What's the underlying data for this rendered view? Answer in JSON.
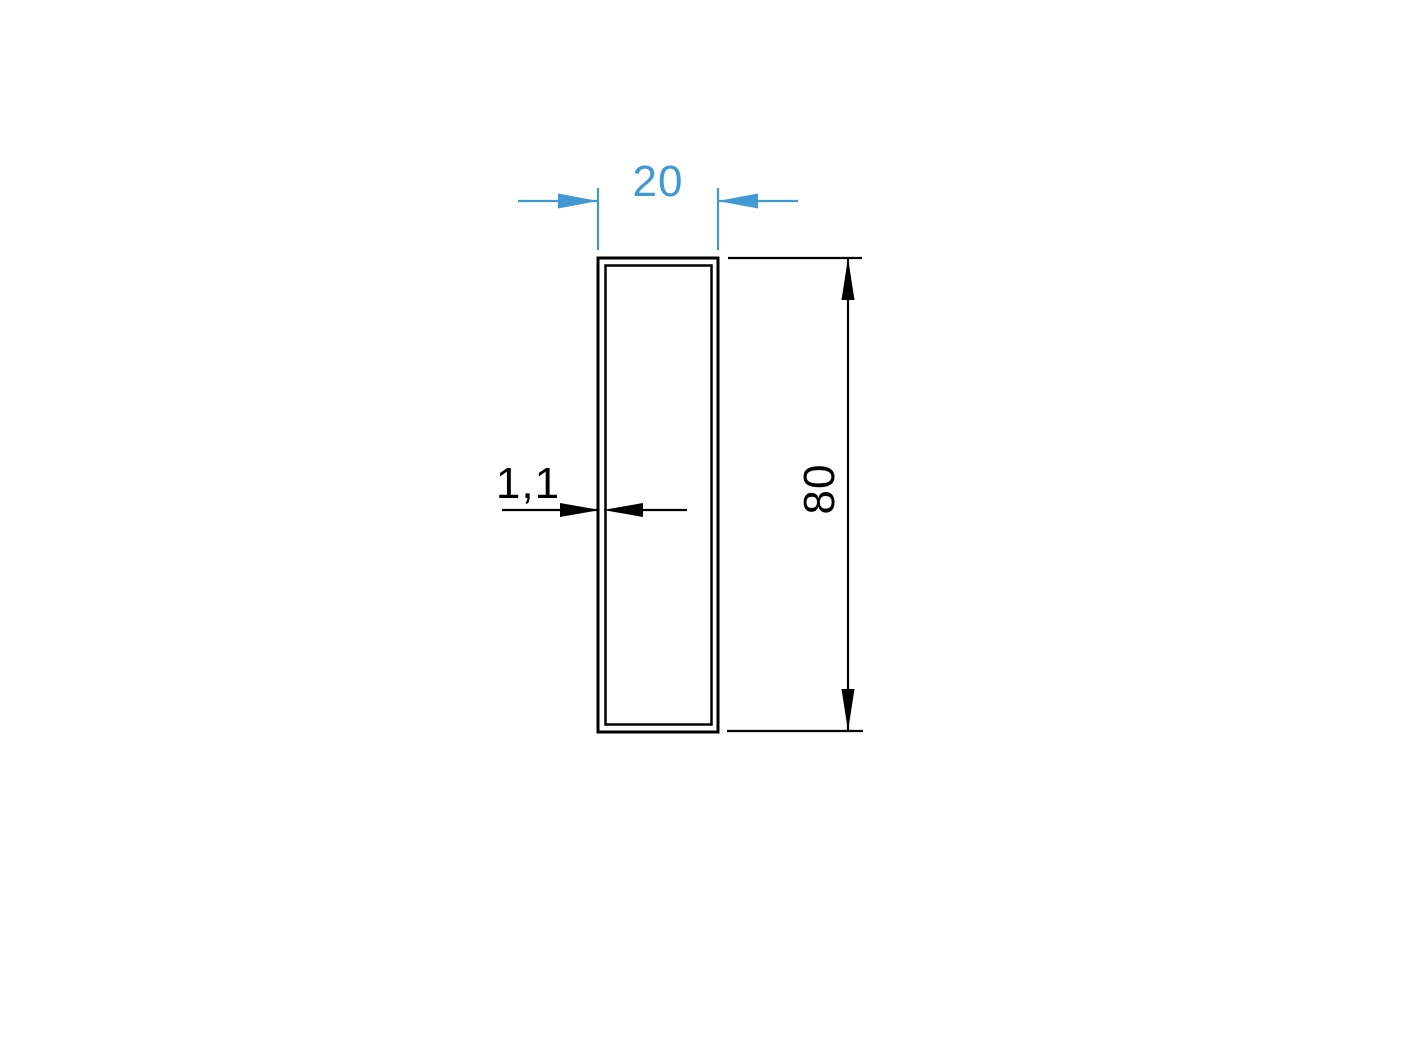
{
  "drawing": {
    "type": "technical-profile-cross-section",
    "dimensions": {
      "width": {
        "value": "20",
        "unit_hint": "",
        "orientation": "horizontal-top"
      },
      "height": {
        "value": "80",
        "unit_hint": "",
        "orientation": "vertical-right"
      },
      "wall_thickness": {
        "value": "1,1",
        "unit_hint": "",
        "orientation": "horizontal-left"
      }
    },
    "colors": {
      "dimension_blue": "#4198d2",
      "line_black": "#000000",
      "background": "#ffffff"
    }
  }
}
